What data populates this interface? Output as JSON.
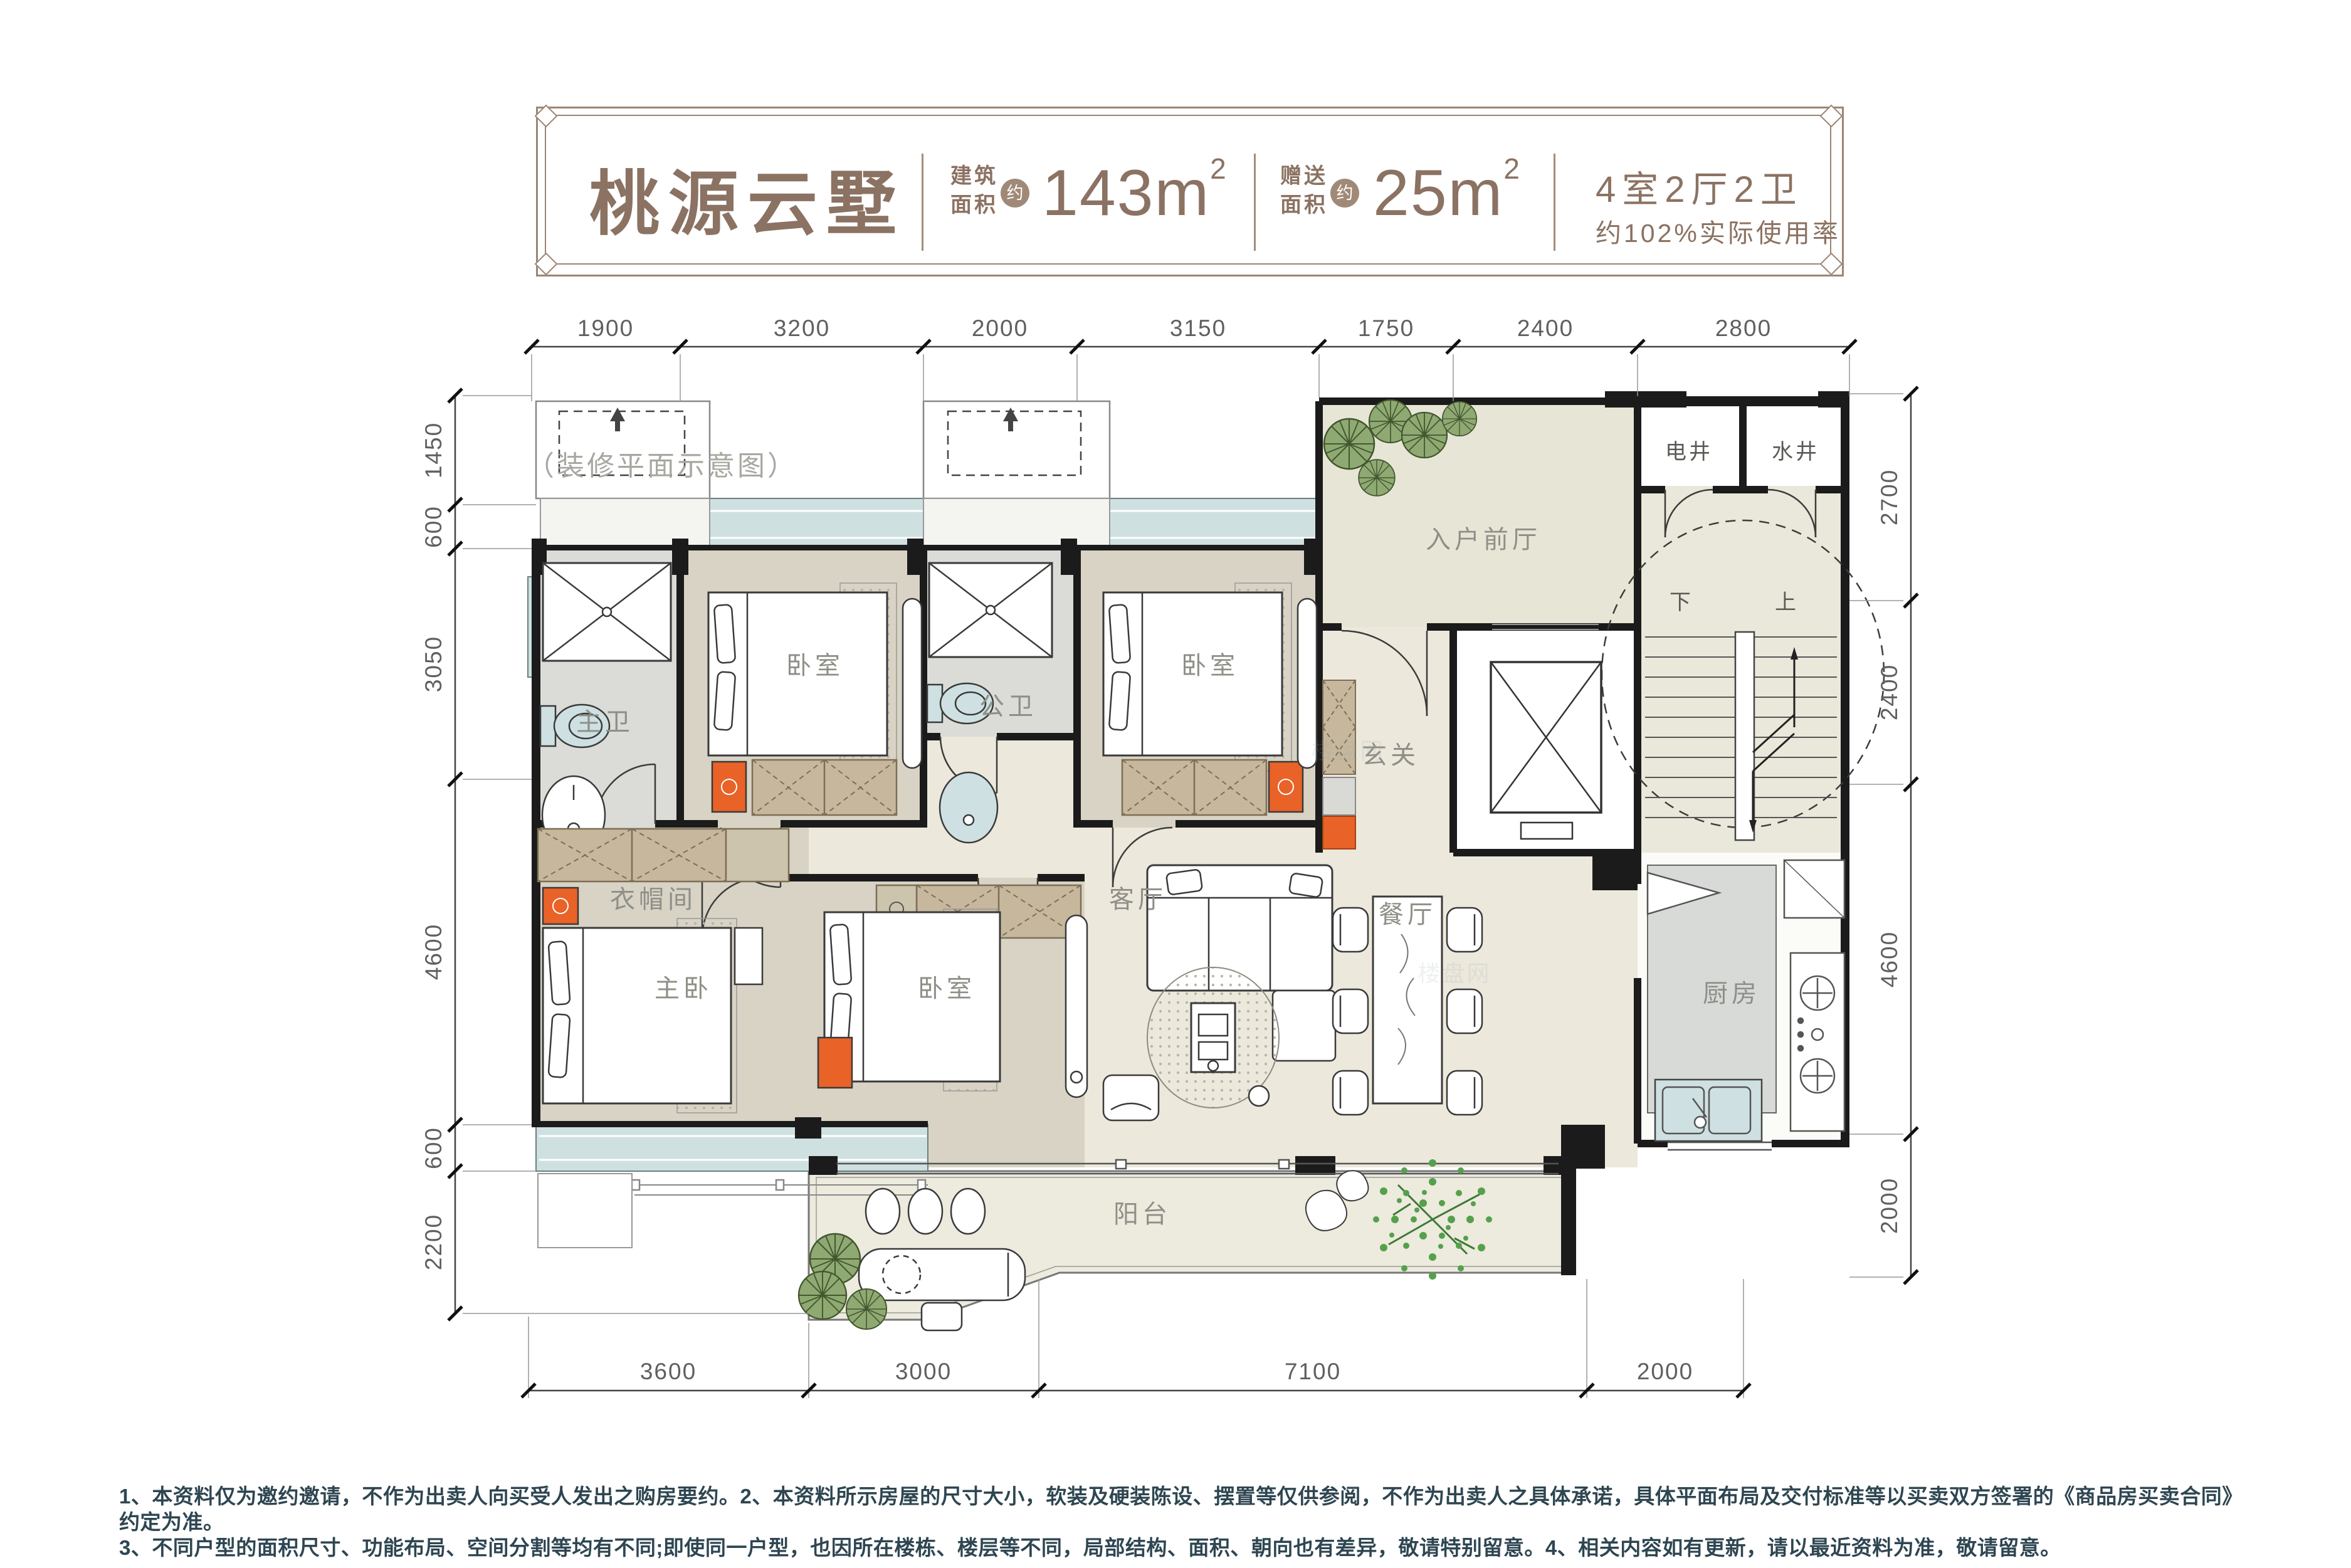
{
  "header": {
    "title": "桃源云墅",
    "build_area": {
      "label_line1": "建筑",
      "label_line2": "面积",
      "approx": "约",
      "value": "143m",
      "sup": "2"
    },
    "gift_area": {
      "label_line1": "赠送",
      "label_line2": "面积",
      "approx": "约",
      "value": "25m",
      "sup": "2"
    },
    "layout_spec": "4室2厅2卫",
    "efficiency": "约102%实际使用率"
  },
  "plan_note": "（装修平面示意图）",
  "rooms": {
    "master_bath": "主卫",
    "bedroom_a": "卧室",
    "public_bath": "公卫",
    "bedroom_b": "卧室",
    "hallway": "玄关",
    "entry_foyer": "入户前厅",
    "electric_shaft": "电井",
    "water_shaft": "水井",
    "stair_down": "下",
    "stair_up": "上",
    "cloakroom": "衣帽间",
    "master_bedroom": "主卧",
    "bedroom_c": "卧室",
    "living_room": "客厅",
    "dining_room": "餐厅",
    "kitchen": "厨房",
    "balcony": "阳台"
  },
  "dimensions": {
    "top": [
      "1900",
      "3200",
      "2000",
      "3150",
      "1750",
      "2400",
      "2800"
    ],
    "left": [
      "1450",
      "600",
      "3050",
      "4600",
      "600",
      "2200"
    ],
    "right": [
      "2700",
      "2400",
      "4600",
      "2000"
    ],
    "bottom": [
      "3600",
      "3000",
      "7100",
      "2000"
    ]
  },
  "watermark": "楼盘网",
  "footer": {
    "line1": "1、本资料仅为邀约邀请，不作为出卖人向买受人发出之购房要约。2、本资料所示房屋的尺寸大小，软装及硬装陈设、摆置等仅供参阅，不作为出卖人之具体承诺，具体平面布局及交付标准等以买卖双方签署的《商品房买卖合同》约定为准。",
    "line2": "3、不同户型的面积尺寸、功能布局、空间分割等均有不同;即使同一户型，也因所在楼栋、楼层等不同，局部结构、面积、朝向也有差异，敬请特别留意。4、相关内容如有更新，请以最近资料为准，敬请留意。"
  },
  "colors": {
    "accent_orange": "#e96227",
    "window_teal": "#cfe0e1",
    "wall_black": "#1b1b1b",
    "title_brown": "#8b7262",
    "floor_cream": "#ece8db",
    "floor_bedroom": "#d8d3c4",
    "floor_bath": "#dbdbd7",
    "floor_foyer": "#e7e6d6",
    "floor_balcony": "#edeade",
    "wardrobe_tan": "#c6b79d",
    "plant_green": "#8fa973",
    "tree_green": "#55a14b",
    "footer_text": "#2e4651"
  }
}
